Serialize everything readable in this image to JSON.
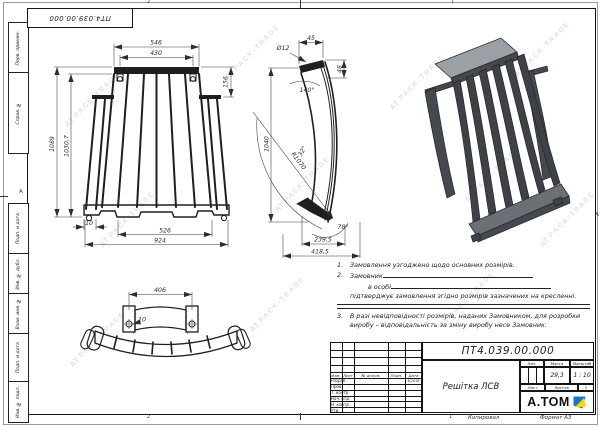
{
  "doc": {
    "number": "ПТ4.039.00.000"
  },
  "sheet_margin": {
    "box1": "Перв. примен.",
    "box2": "Справ. №",
    "box3": "Подп. и дата",
    "box4": "Инв. № дубл.",
    "box5": "Взам. инв. №",
    "box6": "Подп. и дата",
    "box7": "Инв. № подл.",
    "zone_a_left": "А",
    "zone_a_right": "А",
    "zone_2": "2",
    "zone_1": "1"
  },
  "watermark": {
    "mark": "АТ",
    "text": "PACK-TRADE"
  },
  "views": {
    "front": {
      "dims": [
        "546",
        "430",
        "156",
        "1089",
        "1030,7",
        "10",
        "526",
        "924"
      ]
    },
    "side": {
      "dims": [
        "45",
        "Ø12",
        "48",
        "140°",
        "1040",
        "R1070",
        "32°",
        "78°",
        "239,5",
        "418,5"
      ]
    },
    "bottom": {
      "dims": [
        "406",
        "10"
      ]
    }
  },
  "notes": {
    "n1_num": "1.",
    "n1": "Замовлення узгоджено щодо основних розмірів.",
    "n2_num": "2.",
    "n2a": "Замовник",
    "n2b": "в особі",
    "n2c": "підтверджує замовлення згідно розмірів зазначених на кресленні.",
    "n3_num": "3.",
    "n3": "В разі невідповідності розмірів, наданих Замовником, для розробки виробу – відповідальність за зміну виробу несе Замовник."
  },
  "title_block": {
    "cols": [
      "Изм.",
      "Лист",
      "№ докум.",
      "Подп.",
      "Дата"
    ],
    "rows": [
      "Разраб.",
      "Пров.",
      "Т. контр.",
      "Нач. отд.",
      "Н. контр.",
      "Утв."
    ],
    "date": "6.2018",
    "name": "Решітка ЛСВ",
    "lit": "Лит.",
    "mass_label": "Масса",
    "scale_label": "Масштаб",
    "mass": "29,3",
    "scale": "1 : 10",
    "sheet_label": "Лист",
    "sheets_label": "Листов",
    "sheets_value": "1",
    "company": "А.ТОМ"
  },
  "footer": {
    "copied": "Копировал",
    "format": "Формат А3"
  },
  "colors": {
    "logo_blue": "#1877c9",
    "logo_yellow": "#ffd400",
    "line": "#1f1f1f"
  }
}
